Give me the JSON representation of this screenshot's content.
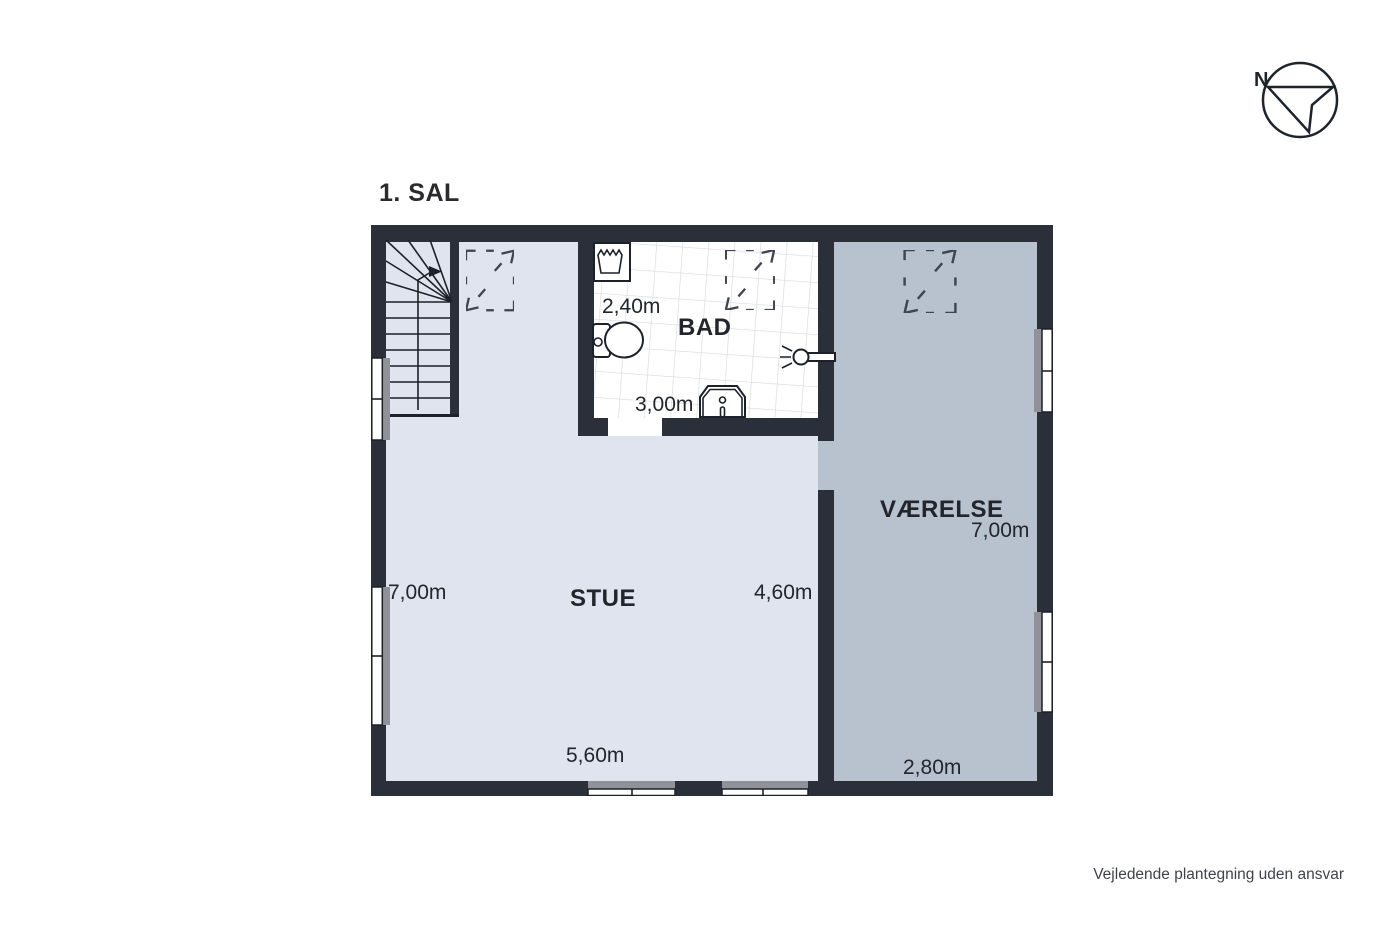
{
  "floor": {
    "title": "1. SAL"
  },
  "rooms": {
    "stue": {
      "label": "STUE",
      "dim_left": "7,00m",
      "dim_right": "4,60m",
      "dim_bottom": "5,60m"
    },
    "bad": {
      "label": "BAD",
      "dim_width": "2,40m",
      "dim_bottom": "3,00m"
    },
    "vaerelse": {
      "label": "VÆRELSE",
      "dim_height": "7,00m",
      "dim_bottom": "2,80m"
    }
  },
  "compass": {
    "north_label": "N"
  },
  "footer": {
    "disclaimer": "Vejledende plantegning uden ansvar"
  },
  "colors": {
    "wall": "#2a2f39",
    "stue_floor": "#dfe4ee",
    "vaerelse_floor": "#b8c1ce",
    "bathroom_floor": "#ffffff",
    "tile_line": "#d6d9e0",
    "window_sill": "#8f9298",
    "line_dark": "#1d2129",
    "skylight_stroke": "#3e4450",
    "text": "#22262c"
  }
}
